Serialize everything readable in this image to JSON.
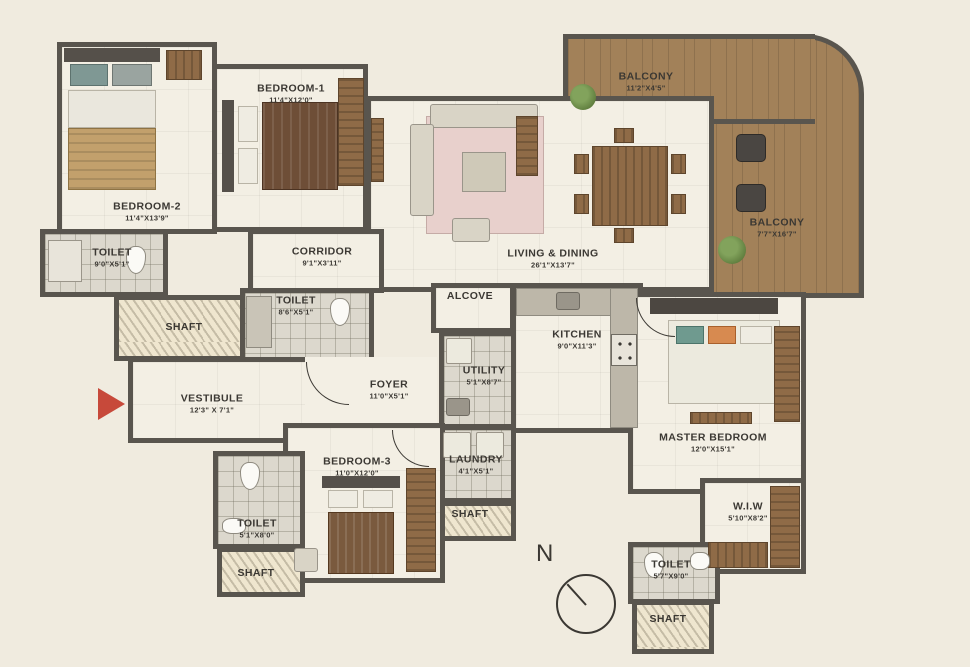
{
  "plan_title": "apartment-floor-plan",
  "colors": {
    "background": "#f0ebdf",
    "wall": "#59554e",
    "floor": "#f3efe4",
    "balcony_floor": "#a28159",
    "wood": "#8f6b47",
    "entry_arrow_red": "#c7493a",
    "plant_green": "#6d8a4a",
    "label_text": "#3b3833"
  },
  "compass": {
    "label": "N"
  },
  "rooms": {
    "bedroom2": {
      "name": "BEDROOM-2",
      "dims": "11'4\"X13'9\""
    },
    "bedroom1": {
      "name": "BEDROOM-1",
      "dims": "11'4\"X12'0\""
    },
    "bedroom3": {
      "name": "BEDROOM-3",
      "dims": "11'0\"X12'0\""
    },
    "master_bedroom": {
      "name": "MASTER BEDROOM",
      "dims": "12'0\"X15'1\""
    },
    "toilet_b2": {
      "name": "TOILET",
      "dims": "9'0\"X5'1\""
    },
    "toilet_corridor": {
      "name": "TOILET",
      "dims": "8'6\"X5'1\""
    },
    "toilet_b3": {
      "name": "TOILET",
      "dims": "5'1\"X8'0\""
    },
    "toilet_master": {
      "name": "TOILET",
      "dims": "5'7\"X9'0\""
    },
    "corridor": {
      "name": "CORRIDOR",
      "dims": "9'1\"X3'11\""
    },
    "living_dining": {
      "name": "LIVING & DINING",
      "dims": "26'1\"X13'7\""
    },
    "balcony_top": {
      "name": "BALCONY",
      "dims": "11'2\"X4'5\""
    },
    "balcony_right": {
      "name": "BALCONY",
      "dims": "7'7\"X16'7\""
    },
    "alcove": {
      "name": "ALCOVE"
    },
    "kitchen": {
      "name": "KITCHEN",
      "dims": "9'0\"X11'3\""
    },
    "utility": {
      "name": "UTILITY",
      "dims": "5'1\"X8'7\""
    },
    "vestibule": {
      "name": "VESTIBULE",
      "dims": "12'3\" X 7'1\""
    },
    "foyer": {
      "name": "FOYER",
      "dims": "11'0\"X5'1\""
    },
    "laundry": {
      "name": "LAUNDRY",
      "dims": "4'1\"X5'1\""
    },
    "wiw": {
      "name": "W.I.W",
      "dims": "5'10\"X8'2\""
    },
    "shaft_left": {
      "name": "SHAFT"
    },
    "shaft_b3": {
      "name": "SHAFT"
    },
    "shaft_laundry": {
      "name": "SHAFT"
    },
    "shaft_master": {
      "name": "SHAFT"
    }
  }
}
